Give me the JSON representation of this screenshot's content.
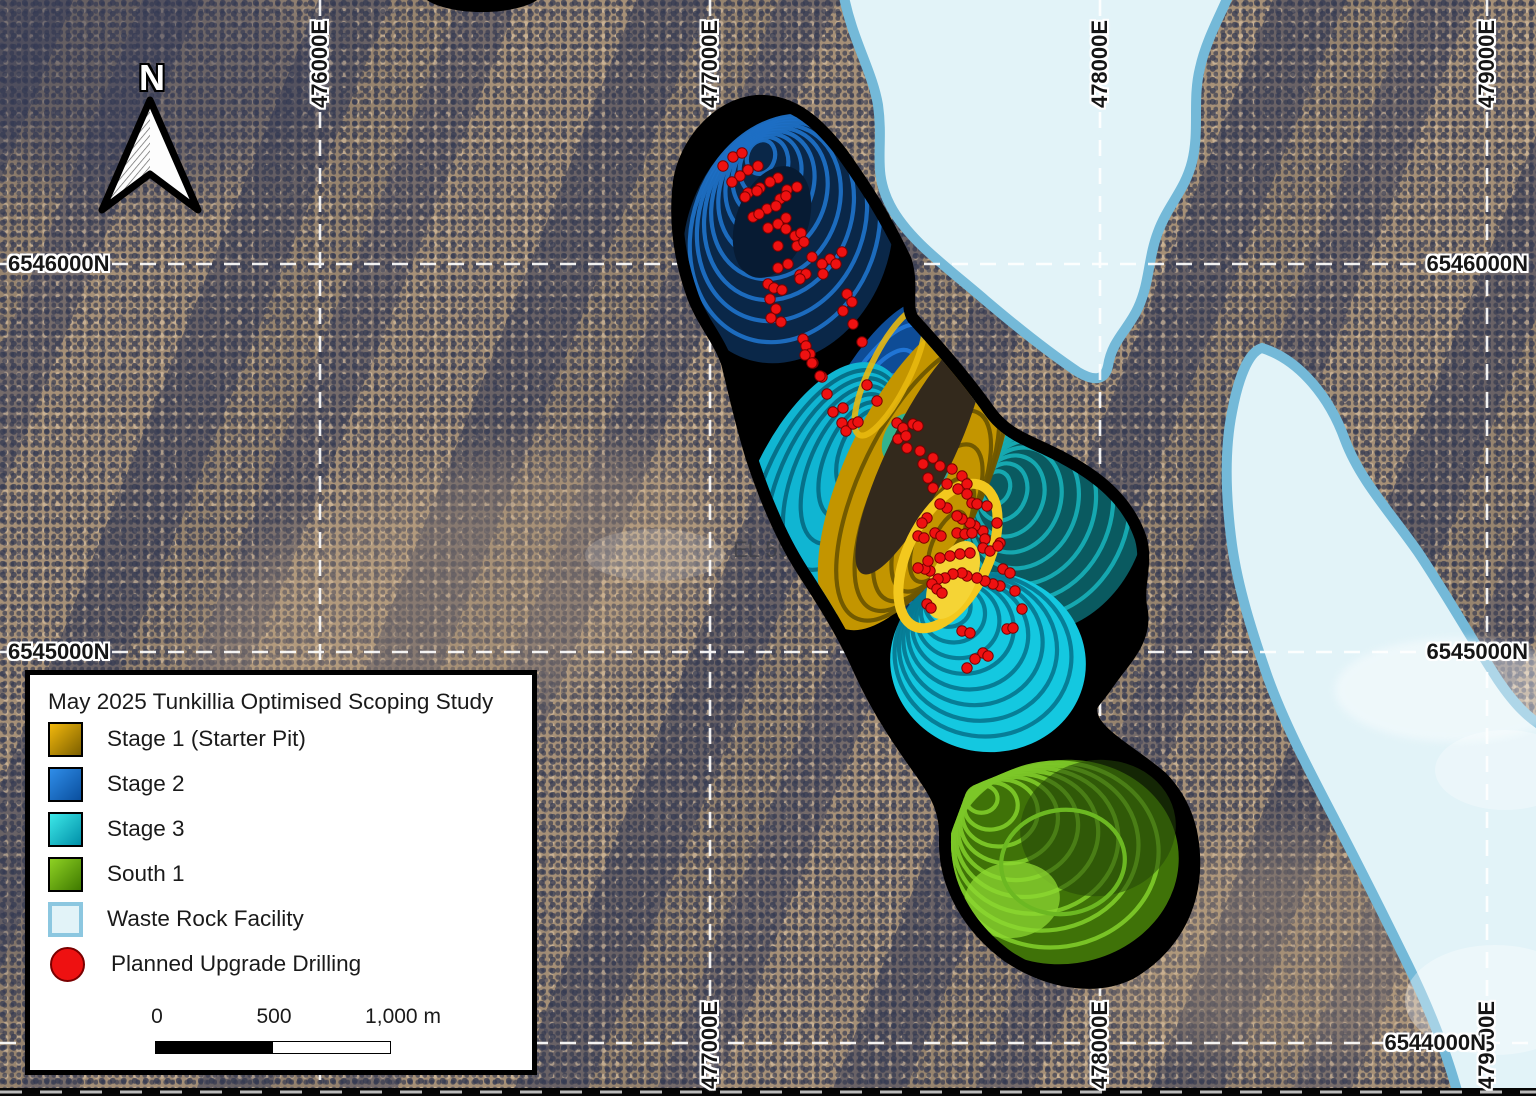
{
  "map": {
    "north_label": "N",
    "bg_description": "aerial scrubland"
  },
  "colors": {
    "stage1": {
      "light": "#F2B80C",
      "dark": "#7C5F00"
    },
    "stage2": {
      "light": "#2F8DE8",
      "dark": "#0A4F9E"
    },
    "stage3": {
      "light": "#3DE8E8",
      "dark": "#008FA8"
    },
    "south1": {
      "light": "#8ED123",
      "dark": "#3F7A00"
    },
    "waste_rock": {
      "fill": "#E2F3F8",
      "border": "#74B9D8"
    },
    "drill": {
      "fill": "#EE1111",
      "border": "#7A0000"
    },
    "pit_outline": "#000000",
    "grid_line": "#FFFFFF"
  },
  "grid": {
    "eastings": [
      {
        "label": "476000E",
        "x": 320,
        "top": true,
        "bottom": false
      },
      {
        "label": "477000E",
        "x": 710,
        "top": true,
        "bottom": true
      },
      {
        "label": "478000E",
        "x": 1100,
        "top": true,
        "bottom": true
      },
      {
        "label": "479000E",
        "x": 1487,
        "top": true,
        "bottom": true
      }
    ],
    "northings": [
      {
        "label": "6546000N",
        "y": 264,
        "left": true,
        "right": true,
        "right_offset": 4
      },
      {
        "label": "6545000N",
        "y": 652,
        "left": true,
        "right": true,
        "right_offset": 4
      },
      {
        "label": "6544000N",
        "y": 1043,
        "left": false,
        "right": true,
        "right_offset": 46
      }
    ]
  },
  "legend": {
    "title": "May 2025 Tunkillia Optimised Scoping Study",
    "items": [
      {
        "label": "Stage 1 (Starter Pit)",
        "swatch": "stage1"
      },
      {
        "label": "Stage 2",
        "swatch": "stage2"
      },
      {
        "label": "Stage 3",
        "swatch": "stage3"
      },
      {
        "label": "South 1",
        "swatch": "south1"
      },
      {
        "label": "Waste Rock Facility",
        "swatch": "waste_rock"
      },
      {
        "label": "Planned Upgrade Drilling",
        "swatch": "drill"
      }
    ],
    "scale": {
      "tick0": "0",
      "tick500": "500",
      "tick1000": "1,000 m"
    }
  },
  "annotations": {
    "tenement_label": "EL 590"
  },
  "drill_points": [
    [
      733,
      157
    ],
    [
      742,
      153
    ],
    [
      723,
      166
    ],
    [
      748,
      170
    ],
    [
      758,
      166
    ],
    [
      740,
      176
    ],
    [
      732,
      182
    ],
    [
      778,
      178
    ],
    [
      770,
      182
    ],
    [
      760,
      188
    ],
    [
      787,
      190
    ],
    [
      797,
      187
    ],
    [
      748,
      193
    ],
    [
      757,
      191
    ],
    [
      745,
      197
    ],
    [
      780,
      199
    ],
    [
      786,
      196
    ],
    [
      767,
      209
    ],
    [
      776,
      206
    ],
    [
      753,
      217
    ],
    [
      759,
      214
    ],
    [
      786,
      218
    ],
    [
      778,
      224
    ],
    [
      768,
      228
    ],
    [
      795,
      236
    ],
    [
      801,
      233
    ],
    [
      786,
      229
    ],
    [
      778,
      246
    ],
    [
      797,
      246
    ],
    [
      804,
      242
    ],
    [
      842,
      252
    ],
    [
      812,
      257
    ],
    [
      830,
      259
    ],
    [
      822,
      264
    ],
    [
      836,
      264
    ],
    [
      788,
      264
    ],
    [
      778,
      268
    ],
    [
      800,
      275
    ],
    [
      806,
      274
    ],
    [
      823,
      274
    ],
    [
      768,
      284
    ],
    [
      774,
      288
    ],
    [
      782,
      290
    ],
    [
      800,
      279
    ],
    [
      847,
      294
    ],
    [
      852,
      302
    ],
    [
      843,
      311
    ],
    [
      770,
      299
    ],
    [
      776,
      309
    ],
    [
      771,
      318
    ],
    [
      781,
      322
    ],
    [
      853,
      324
    ],
    [
      862,
      342
    ],
    [
      803,
      339
    ],
    [
      806,
      346
    ],
    [
      810,
      354
    ],
    [
      813,
      363
    ],
    [
      822,
      377
    ],
    [
      867,
      385
    ],
    [
      805,
      355
    ],
    [
      812,
      363
    ],
    [
      820,
      376
    ],
    [
      827,
      394
    ],
    [
      833,
      412
    ],
    [
      843,
      408
    ],
    [
      842,
      423
    ],
    [
      846,
      431
    ],
    [
      853,
      424
    ],
    [
      858,
      422
    ],
    [
      877,
      401
    ],
    [
      897,
      423
    ],
    [
      903,
      428
    ],
    [
      913,
      424
    ],
    [
      918,
      426
    ],
    [
      898,
      439
    ],
    [
      906,
      436
    ],
    [
      907,
      448
    ],
    [
      920,
      451
    ],
    [
      933,
      458
    ],
    [
      940,
      466
    ],
    [
      952,
      469
    ],
    [
      962,
      476
    ],
    [
      967,
      484
    ],
    [
      923,
      464
    ],
    [
      928,
      478
    ],
    [
      933,
      488
    ],
    [
      947,
      484
    ],
    [
      958,
      489
    ],
    [
      967,
      494
    ],
    [
      972,
      503
    ],
    [
      977,
      504
    ],
    [
      987,
      506
    ],
    [
      997,
      523
    ],
    [
      1000,
      543
    ],
    [
      983,
      531
    ],
    [
      985,
      539
    ],
    [
      975,
      526
    ],
    [
      970,
      523
    ],
    [
      962,
      519
    ],
    [
      957,
      516
    ],
    [
      947,
      508
    ],
    [
      940,
      504
    ],
    [
      927,
      518
    ],
    [
      922,
      523
    ],
    [
      918,
      536
    ],
    [
      924,
      538
    ],
    [
      935,
      533
    ],
    [
      941,
      536
    ],
    [
      957,
      533
    ],
    [
      965,
      534
    ],
    [
      972,
      533
    ],
    [
      983,
      548
    ],
    [
      990,
      551
    ],
    [
      998,
      546
    ],
    [
      1003,
      569
    ],
    [
      1010,
      573
    ],
    [
      1015,
      591
    ],
    [
      1000,
      586
    ],
    [
      993,
      584
    ],
    [
      985,
      581
    ],
    [
      977,
      578
    ],
    [
      967,
      576
    ],
    [
      962,
      573
    ],
    [
      953,
      574
    ],
    [
      945,
      578
    ],
    [
      938,
      579
    ],
    [
      930,
      571
    ],
    [
      925,
      569
    ],
    [
      918,
      568
    ],
    [
      928,
      561
    ],
    [
      940,
      558
    ],
    [
      950,
      556
    ],
    [
      960,
      554
    ],
    [
      970,
      553
    ],
    [
      932,
      584
    ],
    [
      937,
      589
    ],
    [
      942,
      593
    ],
    [
      927,
      604
    ],
    [
      931,
      608
    ],
    [
      962,
      631
    ],
    [
      970,
      633
    ],
    [
      983,
      653
    ],
    [
      988,
      656
    ],
    [
      1007,
      629
    ],
    [
      1013,
      628
    ],
    [
      1022,
      609
    ],
    [
      975,
      659
    ],
    [
      967,
      668
    ]
  ]
}
